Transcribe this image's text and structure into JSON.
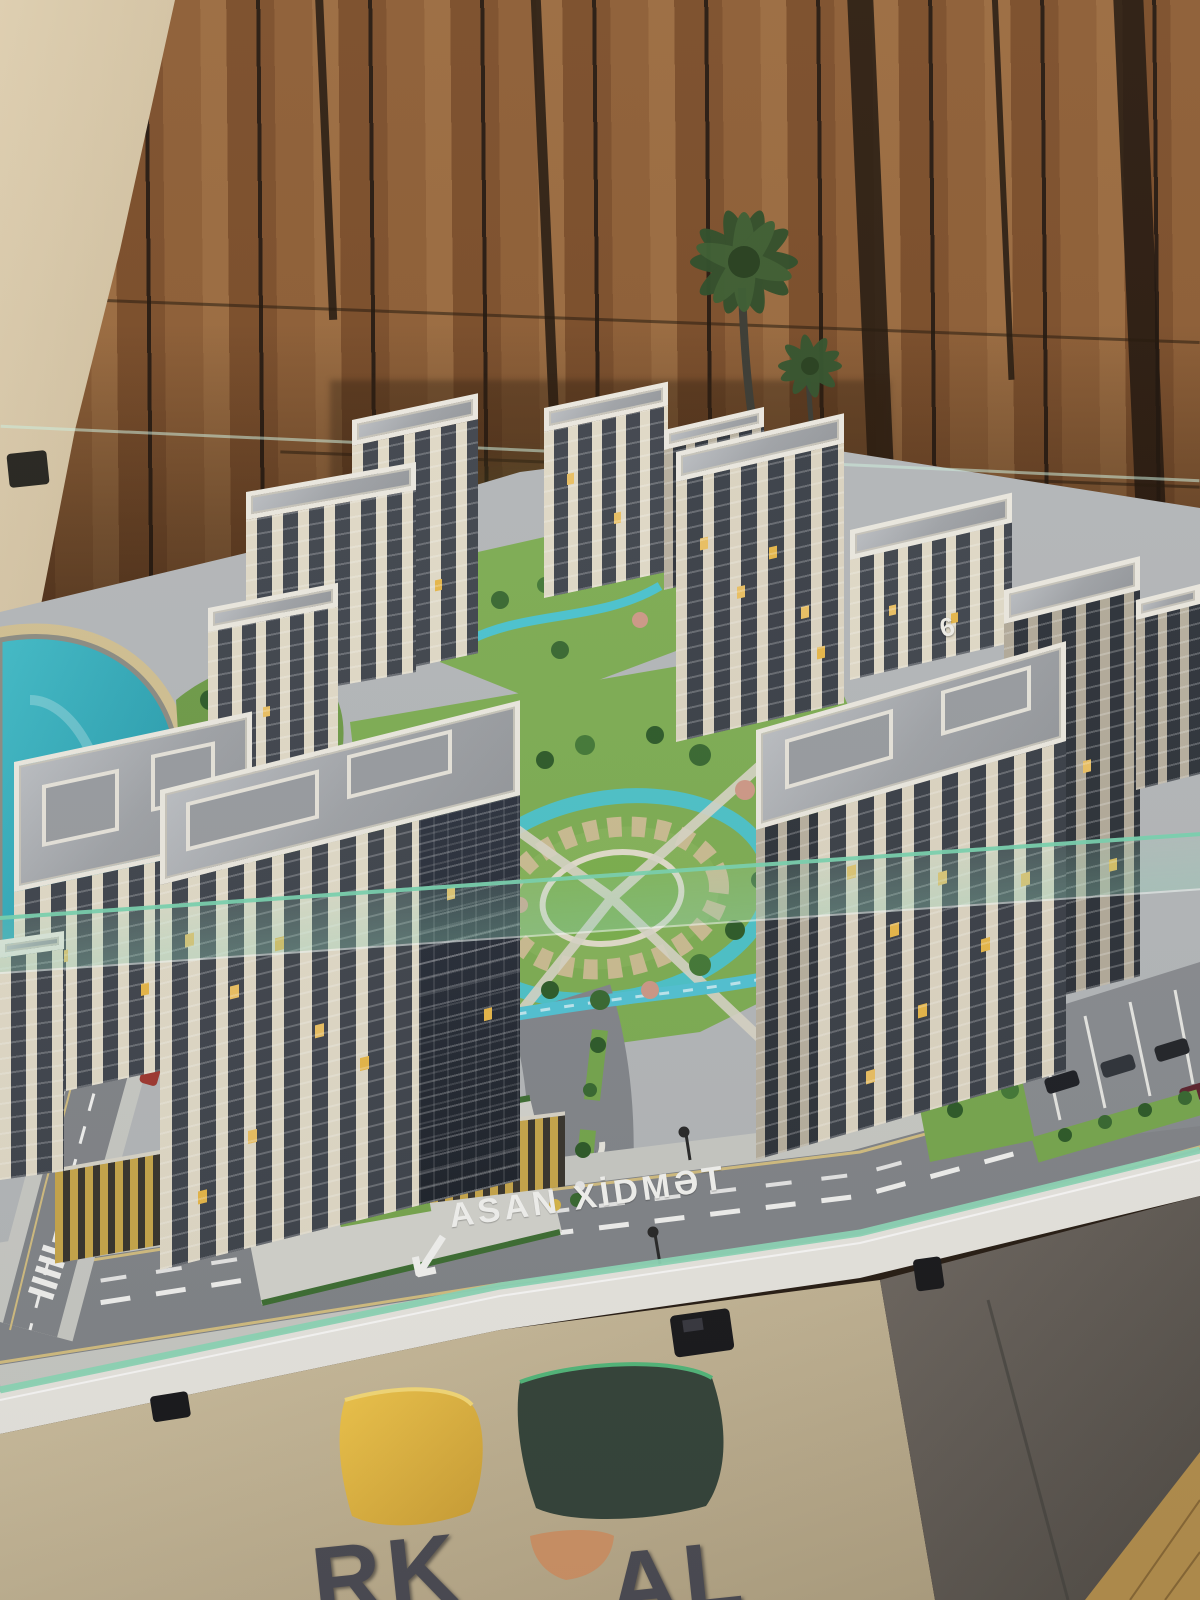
{
  "scene": {
    "type": "architectural scale model photo",
    "road_label": "ASAN XİDMƏT",
    "road_arrow": "↙",
    "rooftop_number": "6",
    "logo": {
      "partial_text_left": "RK",
      "partial_text_right": "AL"
    },
    "colors": {
      "wood_wall": "#8d5d34",
      "beige_wall": "#d6c6a6",
      "lake": "#2fa8b8",
      "lawn": "#79a850",
      "road": "#84878b",
      "building_cream": "#e2dbc8",
      "building_window": "#41464e",
      "lit_window": "#ecc163",
      "glass_rail": "#7ad4b0",
      "logo_panel": "#c9ba99",
      "leaf_yellow": "#e8b83a",
      "leaf_green": "#37463c",
      "leaf_orange": "#cf9468",
      "front_panel": "#6b6259"
    }
  }
}
